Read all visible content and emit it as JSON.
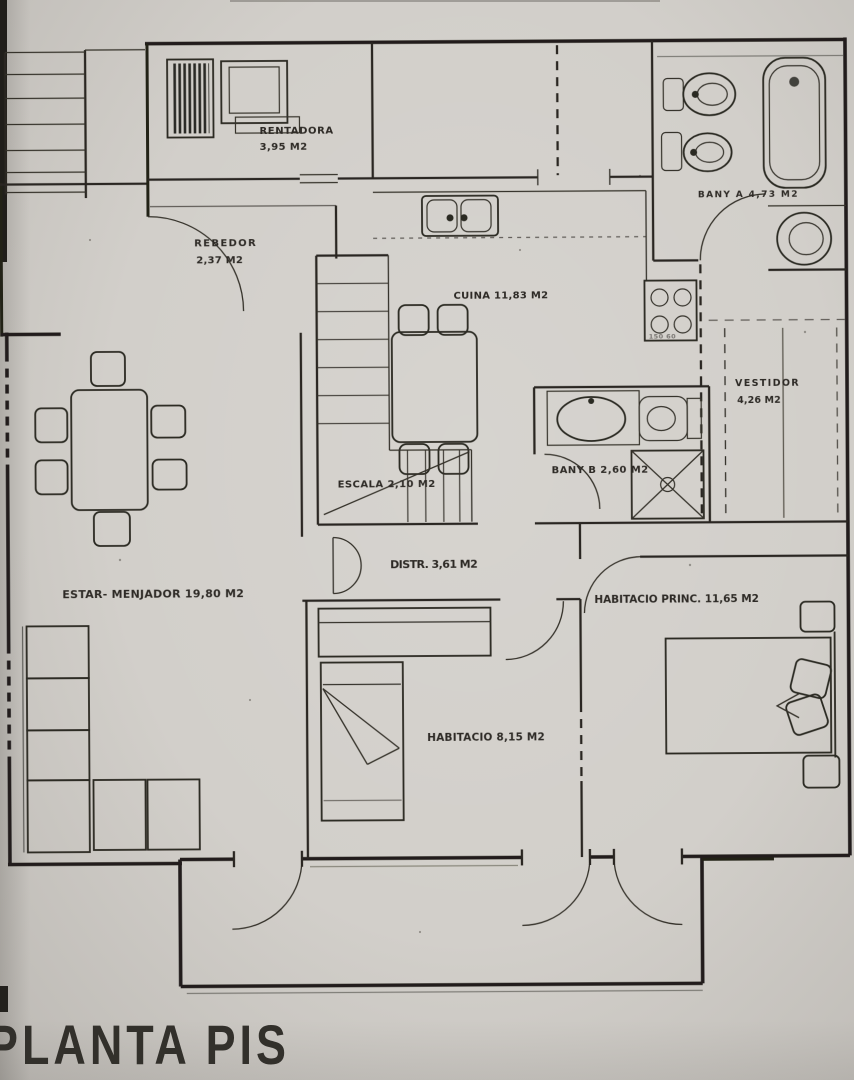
{
  "page": {
    "title": "PLANTA PIS"
  },
  "rooms": {
    "rentadora": {
      "name": "RENTADORA",
      "area": "3,95 M2"
    },
    "rebedor": {
      "name": "REBEDOR",
      "area": "2,37 M2"
    },
    "cuina": {
      "label": "CUINA 11,83 M2"
    },
    "bany_a": {
      "label": "BANY A 4,73 M2"
    },
    "vestidor": {
      "name": "VESTIDOR",
      "area": "4,26 M2"
    },
    "escala": {
      "label": "ESCALA 2,10 M2"
    },
    "bany_b": {
      "label": "BANY B 2,60 M2"
    },
    "distribuidor": {
      "label": "DISTR. 3,61 M2"
    },
    "estar_menjador": {
      "label": "ESTAR- MENJADOR 19,80 M2"
    },
    "habitacio": {
      "label": "HABITACIO 8,15 M2"
    },
    "habitacio_princ": {
      "label": "HABITACIO PRINC. 11,65 M2"
    },
    "stove_dims": "150 60"
  }
}
